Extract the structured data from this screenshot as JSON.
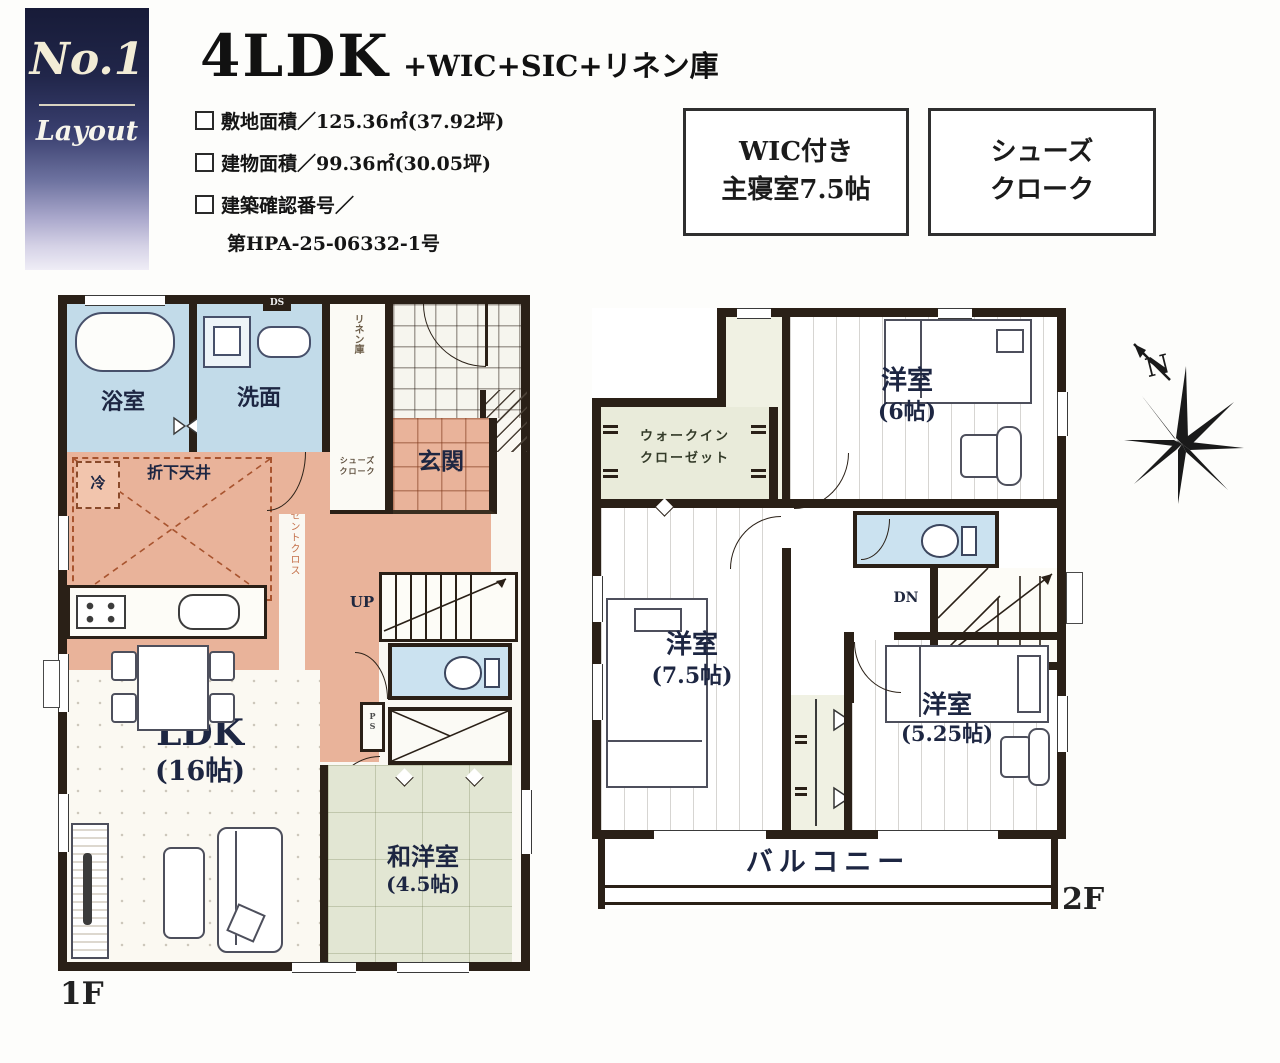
{
  "badge": {
    "number": "No.1",
    "label": "Layout"
  },
  "header": {
    "title": "4LDK",
    "title_suffix": "+WIC+SIC+リネン庫",
    "spec_items": [
      {
        "label": "敷地面積／125.36㎡(37.92坪)"
      },
      {
        "label": "建物面積／99.36㎡(30.05坪)"
      },
      {
        "label": "建築確認番号／"
      }
    ],
    "approval_number": "第HPA-25-06332-1号",
    "feature_box_1": {
      "line1": "WIC付き",
      "line2": "主寝室7.5帖"
    },
    "feature_box_2": {
      "line1": "シューズ",
      "line2": "クローク"
    }
  },
  "floor1": {
    "floor_label": "1F",
    "bath": "浴室",
    "washroom": "洗面",
    "linen": "リネン庫",
    "duct": "DS",
    "entrance": "玄関",
    "shoes_cloak_1": "シューズ",
    "shoes_cloak_2": "クローク",
    "kitchen_ceiling": "折下天井",
    "fridge": "冷",
    "accent_cloth": "天井アクセントクロス",
    "stairs_up": "UP",
    "pipe_space": "PS",
    "ldk": "LDK",
    "ldk_size": "(16帖)",
    "washitsu": "和洋室",
    "washitsu_size": "(4.5帖)"
  },
  "floor2": {
    "floor_label": "2F",
    "wic_1": "ウォークイン",
    "wic_2": "クローゼット",
    "room6": "洋室",
    "room6_size": "(6帖)",
    "room75": "洋室",
    "room75_size": "(7.5帖)",
    "room525": "洋室",
    "room525_size": "(5.25帖)",
    "stairs_down": "DN",
    "balcony": "バルコニー"
  },
  "compass": {
    "north": "N"
  }
}
